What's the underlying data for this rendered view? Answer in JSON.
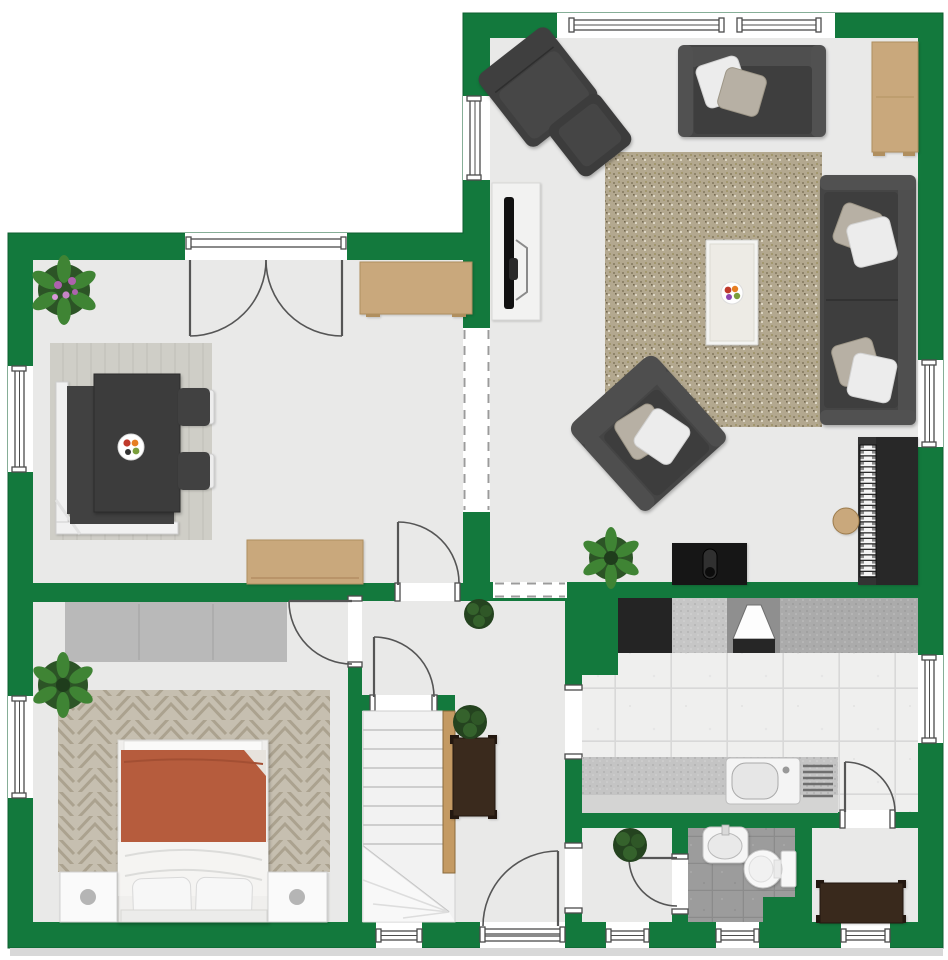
{
  "meta": {
    "title": "Ground floor plan",
    "type": "floor-plan",
    "visible_text": "none"
  },
  "palette": {
    "wall": "#13793d",
    "floor": "#e9e9e8",
    "door": "#555555",
    "stairs": "#f2f2f2",
    "duvet": "#b65c3d",
    "wood": "#c9a87c",
    "sofa": "#464646",
    "console": "#3a2a1d",
    "wardrobe": "#b9b9b9",
    "shadow-strip": "#d8d8d8",
    "kitchen_tile": "#efefee",
    "bathroom_tile": "#9c9c9c",
    "living_rug": "#b3a88f",
    "dining_rug": "#cfcec7",
    "bedroom_rug": "#c6bfb0",
    "plant_green": "#3f8434",
    "plant_dark_green": "#35622c",
    "flower_purple": "#ad62ad",
    "appliance_black": "#242424",
    "counter_gray": "#c6c6c6"
  },
  "rooms": {
    "living_room": {
      "label": "Living room",
      "furniture": [
        "two-seat sofa",
        "wall sofa",
        "armchair with ottoman",
        "armchair",
        "large rug",
        "coffee table with fruit bowl",
        "wall TV on panel",
        "upright piano",
        "piano stool",
        "fireplace stove",
        "tan cabinet",
        "plant"
      ]
    },
    "dining_room": {
      "label": "Dining room",
      "furniture": [
        "dining table",
        "corner bench",
        "2 chairs",
        "rug",
        "fruit bowl",
        "sideboard",
        "desk",
        "flowering plant"
      ]
    },
    "bedroom": {
      "label": "Bedroom",
      "furniture": [
        "double bed",
        "2 nightstands",
        "wardrobe",
        "herringbone rug",
        "plant"
      ]
    },
    "hallway": {
      "label": "Hallway",
      "furniture": [
        "staircase with handrail",
        "console table",
        "2 plants"
      ]
    },
    "kitchen": {
      "label": "Kitchen",
      "furniture": [
        "cooktop counter",
        "extractor hood",
        "sink counter",
        "drainer"
      ]
    },
    "utility_room": {
      "label": "Utility room",
      "furniture": [
        "plant"
      ]
    },
    "bathroom": {
      "label": "Bathroom",
      "furniture": [
        "wash basin",
        "toilet"
      ]
    },
    "storage_room": {
      "label": "Storage room",
      "furniture": [
        "dark dresser"
      ]
    }
  },
  "openings": {
    "windows": [
      "living-north-large",
      "living-north-small",
      "living-west",
      "dining-west",
      "bedroom-west",
      "living-east",
      "kitchen-east",
      "hall-south",
      "utility-south",
      "bathroom-south",
      "storage-south"
    ],
    "doors": [
      "dining-french-doors",
      "bedroom-door",
      "dining-hall-door",
      "staircase-door",
      "kitchen-storage-door",
      "utility-bathroom-door",
      "entrance-door"
    ],
    "passages": [
      "dining-living-dashed",
      "hall-living-dashed",
      "hall-kitchen",
      "hall-utility"
    ]
  }
}
